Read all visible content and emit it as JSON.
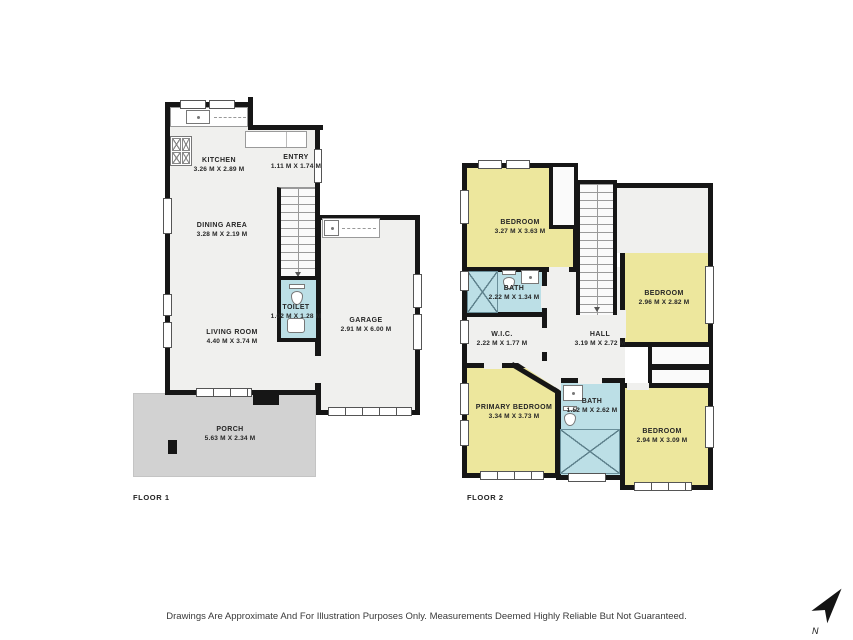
{
  "colors": {
    "wall": "#161616",
    "floor_fill": "#f0f0ee",
    "bedroom_fill": "#ede79d",
    "bath_fill": "#bcdfe6",
    "porch_fill": "#d2d2d2",
    "page": "#ffffff"
  },
  "floor1": {
    "label": "FLOOR 1",
    "rooms": {
      "kitchen": {
        "name": "KITCHEN",
        "dims": "3.26 M X 2.89 M"
      },
      "entry": {
        "name": "ENTRY",
        "dims": "1.11 M X 1.74 M"
      },
      "dining": {
        "name": "DINING AREA",
        "dims": "3.28 M X 2.19 M"
      },
      "toilet": {
        "name": "TOILET",
        "dims": "1.02 M X 1.28 M"
      },
      "living": {
        "name": "LIVING ROOM",
        "dims": "4.40 M X 3.74 M"
      },
      "garage": {
        "name": "GARAGE",
        "dims": "2.91 M X 6.00 M"
      },
      "porch": {
        "name": "PORCH",
        "dims": "5.63 M X 2.34 M"
      }
    }
  },
  "floor2": {
    "label": "FLOOR 2",
    "rooms": {
      "bedroom_tl": {
        "name": "BEDROOM",
        "dims": "3.27 M X 3.63 M"
      },
      "bath_top": {
        "name": "BATH",
        "dims": "2.22 M X 1.34 M"
      },
      "bedroom_tr": {
        "name": "BEDROOM",
        "dims": "2.96 M X 2.82 M"
      },
      "wic": {
        "name": "W.I.C.",
        "dims": "2.22 M X 1.77 M"
      },
      "hall": {
        "name": "HALL",
        "dims": "3.19 M X 2.72 M"
      },
      "primary": {
        "name": "PRIMARY BEDROOM",
        "dims": "3.34 M X 3.73 M"
      },
      "bath_bottom": {
        "name": "BATH",
        "dims": "1.52 M X 2.62 M"
      },
      "bedroom_br": {
        "name": "BEDROOM",
        "dims": "2.94 M X 3.09 M"
      }
    }
  },
  "footer": {
    "disclaimer": "Drawings Are Approximate And For Illustration Purposes Only. Measurements Deemed Highly Reliable But Not Guaranteed."
  },
  "compass": {
    "label": "N"
  }
}
